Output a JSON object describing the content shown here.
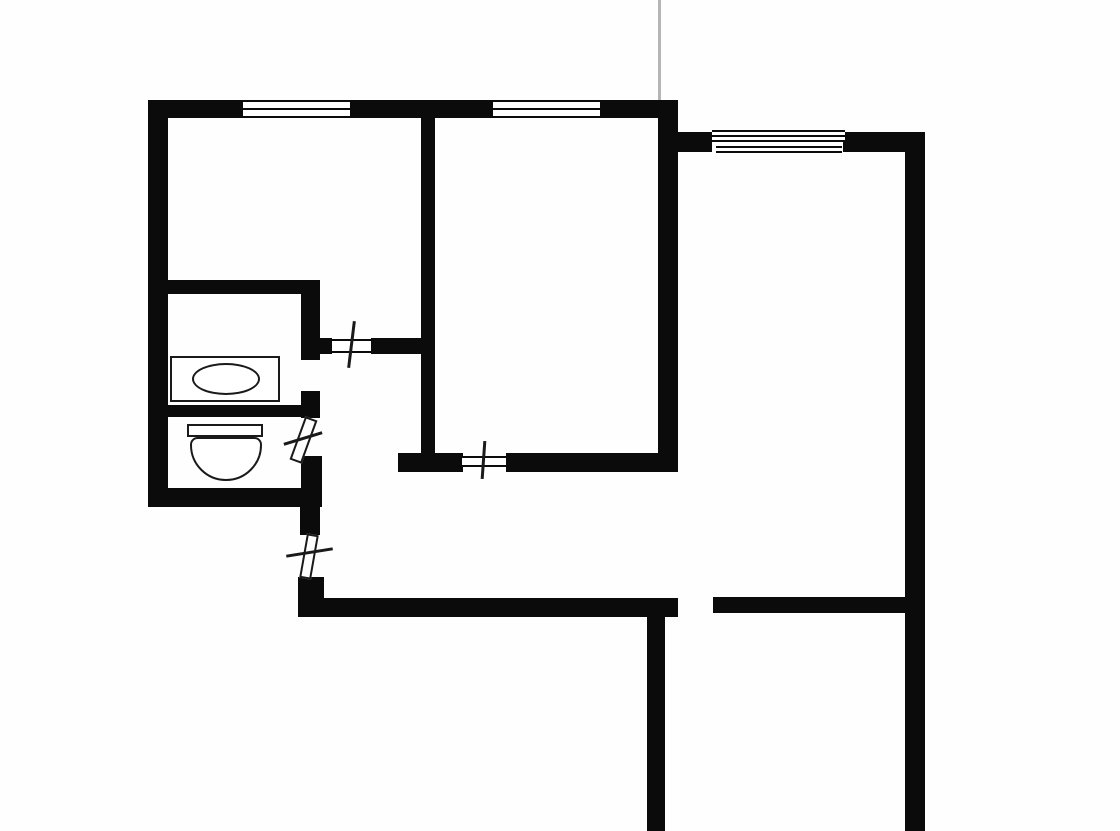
{
  "canvas": {
    "width": 1120,
    "height": 831,
    "background": "#fefefe",
    "wall_color": "#0b0b0b",
    "fixture_line_color": "#1a1a1a",
    "faint_line_color": "#b5b5b5"
  },
  "elements": [
    {
      "name": "top-wall-left",
      "t": "wall",
      "x": 148,
      "y": 100,
      "w": 95,
      "h": 18
    },
    {
      "name": "top-wall-mid",
      "t": "wall",
      "x": 350,
      "y": 100,
      "w": 143,
      "h": 18
    },
    {
      "name": "top-wall-right",
      "t": "wall",
      "x": 600,
      "y": 100,
      "w": 78,
      "h": 18
    },
    {
      "name": "middleroom-right-wall",
      "t": "wall",
      "x": 658,
      "y": 100,
      "w": 20,
      "h": 372
    },
    {
      "name": "left-outer-wall",
      "t": "wall",
      "x": 148,
      "y": 100,
      "w": 20,
      "h": 407
    },
    {
      "name": "rightsection-top-wall-left",
      "t": "wall",
      "x": 678,
      "y": 132,
      "w": 34,
      "h": 20
    },
    {
      "name": "rightsection-top-wall-right",
      "t": "wall",
      "x": 843,
      "y": 132,
      "w": 82,
      "h": 20
    },
    {
      "name": "right-outer-wall",
      "t": "wall",
      "x": 905,
      "y": 132,
      "w": 20,
      "h": 699
    },
    {
      "name": "middleroom-left-wall",
      "t": "wall",
      "x": 421,
      "y": 117,
      "w": 14,
      "h": 353
    },
    {
      "name": "bathroom-top-wall",
      "t": "wall",
      "x": 148,
      "y": 280,
      "w": 170,
      "h": 14
    },
    {
      "name": "bathroom-right-wall-upper",
      "t": "wall",
      "x": 301,
      "y": 280,
      "w": 19,
      "h": 80
    },
    {
      "name": "bath-toilet-divider-wall",
      "t": "wall",
      "x": 148,
      "y": 405,
      "w": 170,
      "h": 12
    },
    {
      "name": "bathroom-right-stub",
      "t": "wall",
      "x": 301,
      "y": 391,
      "w": 19,
      "h": 27
    },
    {
      "name": "toilet-right-wall",
      "t": "wall",
      "x": 301,
      "y": 456,
      "w": 21,
      "h": 51
    },
    {
      "name": "toilet-bottom-wall",
      "t": "wall",
      "x": 148,
      "y": 488,
      "w": 174,
      "h": 19
    },
    {
      "name": "hall-left-wall-upper",
      "t": "wall",
      "x": 300,
      "y": 505,
      "w": 20,
      "h": 30
    },
    {
      "name": "entry-corner-wall",
      "t": "wall",
      "x": 298,
      "y": 577,
      "w": 26,
      "h": 40
    },
    {
      "name": "hall-bottom-wall",
      "t": "wall",
      "x": 322,
      "y": 598,
      "w": 356,
      "h": 19
    },
    {
      "name": "room1-door-stub-left",
      "t": "wall",
      "x": 317,
      "y": 338,
      "w": 15,
      "h": 16
    },
    {
      "name": "room1-door-wall-right",
      "t": "wall",
      "x": 371,
      "y": 338,
      "w": 51,
      "h": 16
    },
    {
      "name": "middleroom-bottom-wall-left",
      "t": "wall",
      "x": 398,
      "y": 453,
      "w": 65,
      "h": 19
    },
    {
      "name": "middleroom-bottom-wall-right",
      "t": "wall",
      "x": 506,
      "y": 453,
      "w": 161,
      "h": 19
    },
    {
      "name": "bottomright-room-top-wall",
      "t": "wall",
      "x": 713,
      "y": 597,
      "w": 192,
      "h": 16
    },
    {
      "name": "bottomright-room-left-wall",
      "t": "wall",
      "x": 647,
      "y": 598,
      "w": 18,
      "h": 233
    },
    {
      "name": "window-room1",
      "t": "window",
      "x": 243,
      "y": 100,
      "w": 107,
      "h": 18
    },
    {
      "name": "window-room2",
      "t": "window",
      "x": 493,
      "y": 100,
      "w": 107,
      "h": 18
    },
    {
      "name": "window-room3-upper",
      "t": "window",
      "x": 712,
      "y": 130,
      "w": 133,
      "h": 12
    },
    {
      "name": "window-room3-lower",
      "t": "window",
      "x": 716,
      "y": 140,
      "w": 126,
      "h": 13
    },
    {
      "name": "room1-door-frame",
      "t": "door-frame",
      "x": 330,
      "y": 339,
      "w": 43,
      "h": 14
    },
    {
      "name": "middleroom-door-frame",
      "t": "door-frame-tb",
      "x": 462,
      "y": 456,
      "w": 44,
      "h": 11
    },
    {
      "name": "toilet-door-leaf",
      "t": "leaf",
      "x": 297,
      "y": 417,
      "w": 13,
      "h": 46,
      "r": 20
    },
    {
      "name": "entry-door-leaf",
      "t": "leaf",
      "x": 303,
      "y": 534,
      "w": 12,
      "h": 45,
      "r": 10
    },
    {
      "name": "room1-door-swing-tick",
      "t": "tick",
      "x": 350,
      "y": 321,
      "w": 3,
      "h": 47,
      "r": 7
    },
    {
      "name": "toilet-door-swing-tick",
      "t": "tick",
      "x": 283,
      "y": 437,
      "w": 40,
      "h": 3,
      "r": -17
    },
    {
      "name": "middleroom-door-swing-tick",
      "t": "tick",
      "x": 482,
      "y": 441,
      "w": 3,
      "h": 38,
      "r": 4
    },
    {
      "name": "entry-door-swing-tick",
      "t": "tick",
      "x": 286,
      "y": 551,
      "w": 47,
      "h": 3,
      "r": -9
    },
    {
      "name": "bathtub",
      "t": "fix-rect",
      "x": 170,
      "y": 356,
      "w": 110,
      "h": 46
    },
    {
      "name": "bathtub-basin",
      "t": "fix-ellipse",
      "x": 192,
      "y": 363,
      "w": 68,
      "h": 32
    },
    {
      "name": "toilet-tank",
      "t": "fix-rect",
      "x": 187,
      "y": 424,
      "w": 76,
      "h": 13
    },
    {
      "name": "toilet-bowl",
      "t": "fix-bowl",
      "x": 190,
      "y": 437,
      "w": 72,
      "h": 44
    },
    {
      "name": "section-cut-line",
      "t": "stray",
      "x": 658,
      "y": 0,
      "w": 3,
      "h": 100
    }
  ]
}
